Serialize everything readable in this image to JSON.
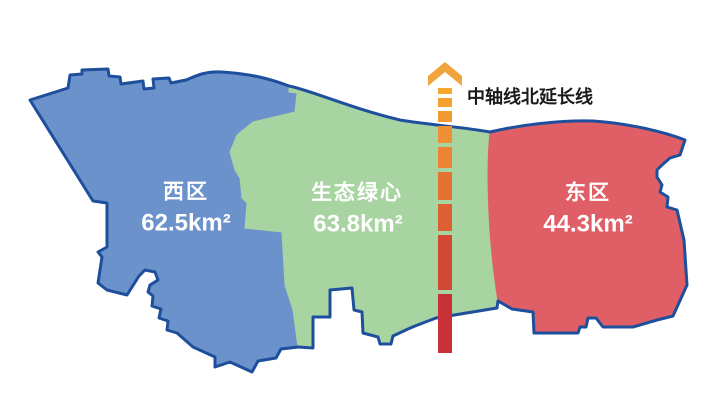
{
  "map": {
    "background_color": "#FFFFFF",
    "outline_color": "#1E4F9C",
    "label_text_color": "#FFFFFF",
    "regions": [
      {
        "name": "西区",
        "area": "62.5km²",
        "color": "#6C92CB"
      },
      {
        "name": "生态绿心",
        "area": "63.8km²",
        "color": "#A8D4A1"
      },
      {
        "name": "东区",
        "area": "44.3km²",
        "color": "#E05F66"
      }
    ],
    "axis": {
      "label": "中轴线北延长线",
      "label_color": "#1A1A1A",
      "arrow_color": "#F2A43C",
      "gradient_start": "#F5A72E",
      "gradient_end": "#C93139"
    }
  }
}
